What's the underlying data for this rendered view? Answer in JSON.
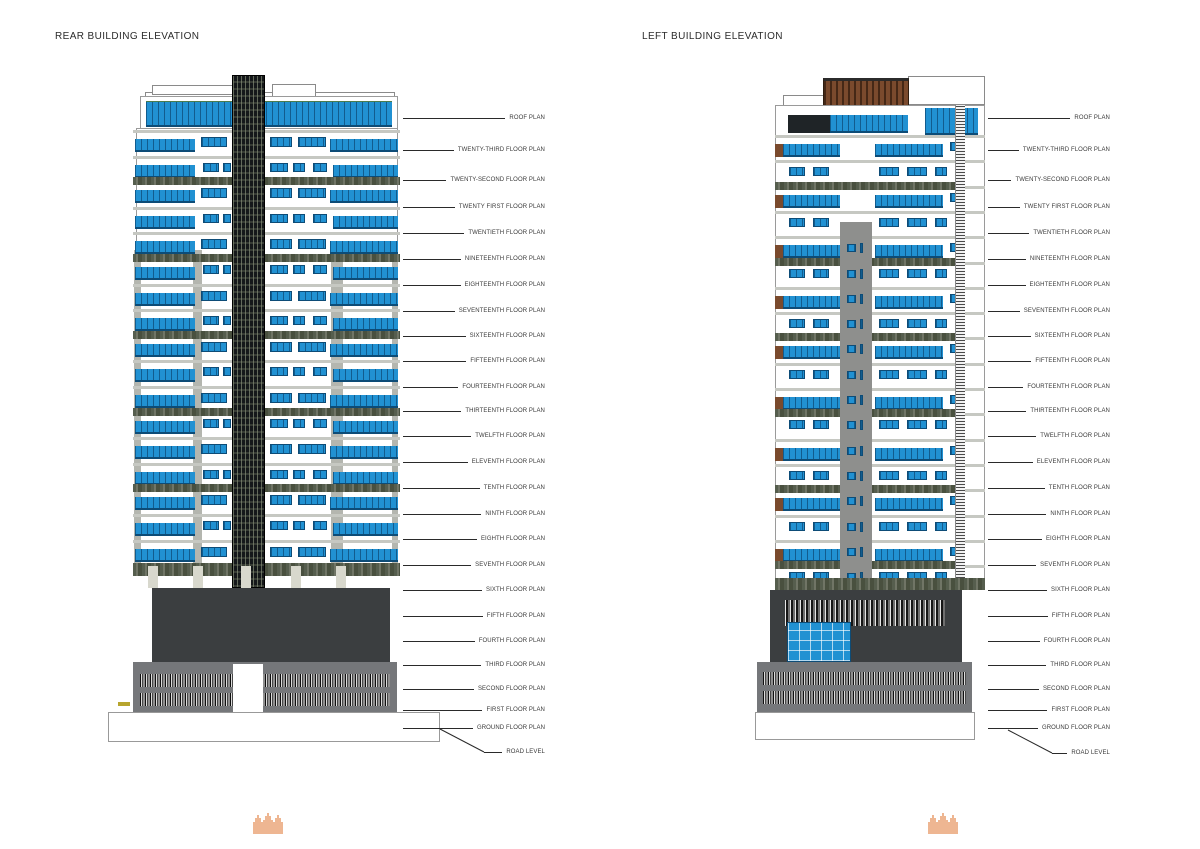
{
  "sheet": {
    "background": "#ffffff"
  },
  "panels": [
    {
      "id": "rear",
      "title": "REAR BUILDING ELEVATION",
      "floor_labels": [
        "ROOF PLAN",
        "TWENTY-THIRD FLOOR PLAN",
        "TWENTY-SECOND FLOOR PLAN",
        "TWENTY FIRST FLOOR PLAN",
        "TWENTIETH FLOOR PLAN",
        "NINETEENTH FLOOR PLAN",
        "EIGHTEENTH FLOOR PLAN",
        "SEVENTEENTH FLOOR PLAN",
        "SIXTEENTH FLOOR PLAN",
        "FIFTEENTH FLOOR PLAN",
        "FOURTEENTH FLOOR PLAN",
        "THIRTEENTH FLOOR PLAN",
        "TWELFTH FLOOR PLAN",
        "ELEVENTH FLOOR PLAN",
        "TENTH FLOOR PLAN",
        "NINTH FLOOR PLAN",
        "EIGHTH FLOOR PLAN",
        "SEVENTH FLOOR PLAN",
        "SIXTH FLOOR PLAN",
        "FIFTH FLOOR PLAN",
        "FOURTH FLOOR PLAN",
        "THIRD FLOOR PLAN",
        "SECOND FLOOR PLAN",
        "FIRST FLOOR PLAN",
        "GROUND FLOOR PLAN",
        "ROAD LEVEL"
      ]
    },
    {
      "id": "left",
      "title": "LEFT BUILDING ELEVATION",
      "floor_labels": [
        "ROOF PLAN",
        "TWENTY-THIRD FLOOR PLAN",
        "TWENTY-SECOND FLOOR PLAN",
        "TWENTY FIRST FLOOR PLAN",
        "TWENTIETH FLOOR PLAN",
        "NINETEENTH FLOOR PLAN",
        "EIGHTEENTH FLOOR PLAN",
        "SEVENTEENTH FLOOR PLAN",
        "SIXTEENTH FLOOR PLAN",
        "FIFTEENTH FLOOR PLAN",
        "FOURTEENTH FLOOR PLAN",
        "THIRTEENTH FLOOR PLAN",
        "TWELFTH FLOOR PLAN",
        "ELEVENTH FLOOR PLAN",
        "TENTH FLOOR PLAN",
        "NINTH FLOOR PLAN",
        "EIGHTH FLOOR PLAN",
        "SEVENTH FLOOR PLAN",
        "SIXTH FLOOR PLAN",
        "FIFTH FLOOR PLAN",
        "FOURTH FLOOR PLAN",
        "THIRD FLOOR PLAN",
        "SECOND FLOOR PLAN",
        "FIRST FLOOR PLAN",
        "GROUND FLOOR PLAN",
        "ROAD LEVEL"
      ]
    }
  ],
  "colors": {
    "glazing_blue": "#2191d2",
    "mullion_blue": "#0d4c77",
    "dark_mass": "#3b3e40",
    "podium_gray": "#75777a",
    "core_dark": "#15181a",
    "pergola_brown": "#7a4a2d",
    "vegetation_green": "#565e4e",
    "logo_orange": "#e07b39",
    "line_black": "#2a2a2a"
  },
  "logo": {
    "icon": "castle-towers-icon"
  }
}
